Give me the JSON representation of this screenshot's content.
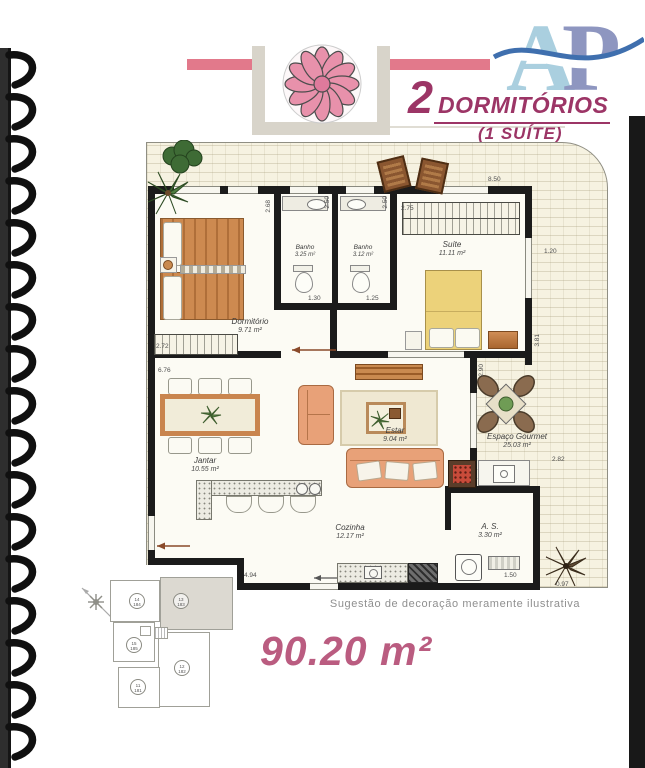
{
  "header": {
    "logo": {
      "letter_a": "A",
      "letter_p": "P"
    },
    "title_number": "2",
    "title_text": "DORMITÓRIOS",
    "subtitle": "(1 SUÍTE)"
  },
  "rooms": {
    "dormitorio": {
      "name": "Dormitório",
      "area": "9.71 m²"
    },
    "banho1": {
      "name": "Banho",
      "area": "3.25 m²"
    },
    "banho2": {
      "name": "Banho",
      "area": "3.12 m²"
    },
    "suite": {
      "name": "Suíte",
      "area": "11.11 m²"
    },
    "jantar": {
      "name": "Jantar",
      "area": "10.55 m²"
    },
    "estar": {
      "name": "Estar",
      "area": "9.04 m²"
    },
    "cozinha": {
      "name": "Cozinha",
      "area": "12.17 m²"
    },
    "area_servico": {
      "name": "A. S.",
      "area": "3.30 m²"
    },
    "gourmet": {
      "name": "Espaço Gourmet",
      "area": "25.03 m²"
    }
  },
  "dims": {
    "terrace_top": "8.50",
    "terrace_right": "1.20",
    "dorm_wall": "2.68",
    "banho1_wall": "2.50",
    "banho2_wall": "2.50",
    "suite_closet": "2.75",
    "dorm_wardrobe": "2.72",
    "jantar_top": "6.76",
    "banho1_width": "1.30",
    "banho2_width": "1.25",
    "suite_right": "3.81",
    "estar_right": "2.90",
    "gourmet_right": "2.82",
    "cozinha_bottom": "4.94",
    "as_width": "1.50",
    "palm_corner": "0.97"
  },
  "footer": {
    "caption": "Sugestão de decoração meramente ilustrativa",
    "total_area": "90.20 m²"
  },
  "keyplan": {
    "units": [
      {
        "num": "14",
        "apt": "184"
      },
      {
        "num": "13",
        "apt": "183"
      },
      {
        "num": "15",
        "apt": "185"
      },
      {
        "num": "12",
        "apt": "182"
      },
      {
        "num": "11",
        "apt": "181"
      }
    ]
  },
  "colors": {
    "accent_bar": "#e2798b",
    "title_text": "#9c3566",
    "total_area_text": "#ba5c80",
    "logo_a": "#aacfdf",
    "logo_p": "#8e96c0",
    "wall": "#1b1b1b",
    "plan_paper": "#f6f2e1"
  }
}
